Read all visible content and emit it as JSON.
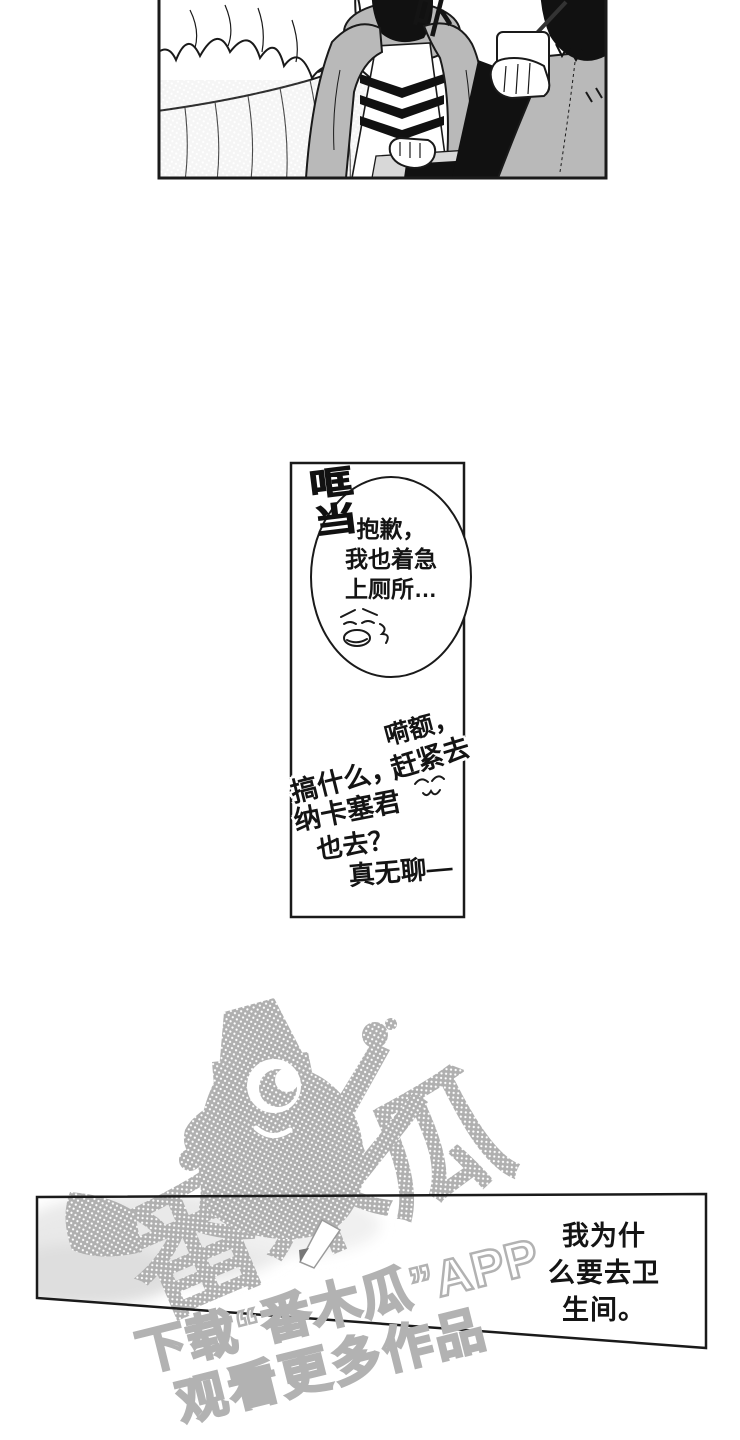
{
  "page": {
    "width": 740,
    "height": 1440,
    "background": "#ffffff"
  },
  "top_panel": {
    "sfx": "卟"
  },
  "middle_panel": {
    "sfx": "哐当",
    "bubble_text": "抱歉，\n我也着急\n上厕所…",
    "handwritten": {
      "line1": "嗬额，",
      "line2": "赶紧去",
      "line3": "搞什么，",
      "line4": "纳卡塞君",
      "line5": "也去？",
      "line6": "真无聊—"
    }
  },
  "bottom_panel": {
    "caption": "我为什\n么要去卫\n生间。"
  },
  "watermark": {
    "brand_large": "番木瓜",
    "line1": "下载“番木瓜”APP",
    "line2": "观看更多作品"
  },
  "colors": {
    "ink": "#1a1a1a",
    "tone_gray": "#b9b9b9",
    "halftone_gray": "#b0b0b0",
    "table_gray": "#d8d8d8",
    "watermark_outline": "#b2b2b2"
  }
}
